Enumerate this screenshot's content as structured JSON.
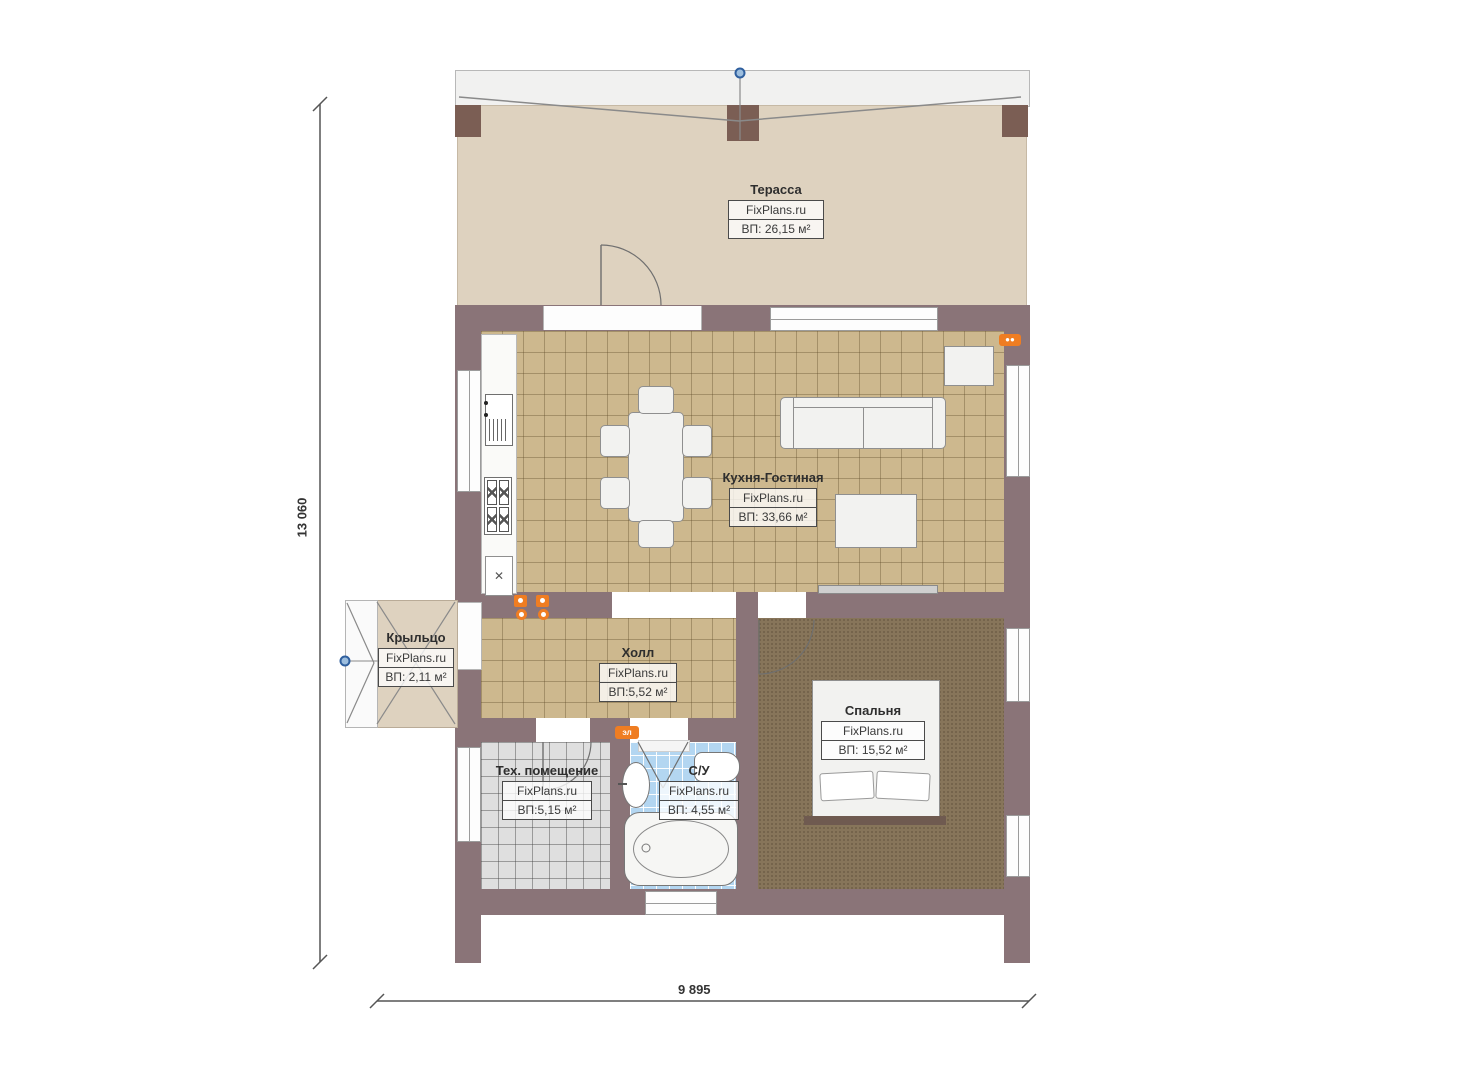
{
  "plan": {
    "watermark": "FixPlans.ru",
    "rooms": [
      {
        "id": "terrace",
        "name": "Терасса",
        "area": "ВП: 26,15 м²"
      },
      {
        "id": "kitchen-living",
        "name": "Кухня-Гостиная",
        "area": "ВП: 33,66 м²"
      },
      {
        "id": "porch",
        "name": "Крыльцо",
        "area": "ВП: 2,11 м²"
      },
      {
        "id": "hall",
        "name": "Холл",
        "area": "ВП:5,52 м²"
      },
      {
        "id": "bedroom",
        "name": "Спальня",
        "area": "ВП: 15,52 м²"
      },
      {
        "id": "tech-room",
        "name": "Тех. помещение",
        "area": "ВП:5,15 м²"
      },
      {
        "id": "bathroom",
        "name": "С/У",
        "area": "ВП: 4,55 м²"
      }
    ],
    "dimensions": {
      "left": "13 060",
      "bottom": "9 895"
    },
    "markers": {
      "electric_label": "эл",
      "kitchen_unit_cross": "✕"
    },
    "colors": {
      "wall": "#8a7478",
      "post": "#7b5e54",
      "terrace_floor": "#ded2bf",
      "tile_floor": "#cdb88e",
      "tech_tile": "#dfdfdf",
      "bath_tile": "#b3d6f1",
      "bedroom_carpet": "#87755a",
      "accent_orange": "#ef7d22",
      "marker_blue": "#3f6fae"
    }
  }
}
